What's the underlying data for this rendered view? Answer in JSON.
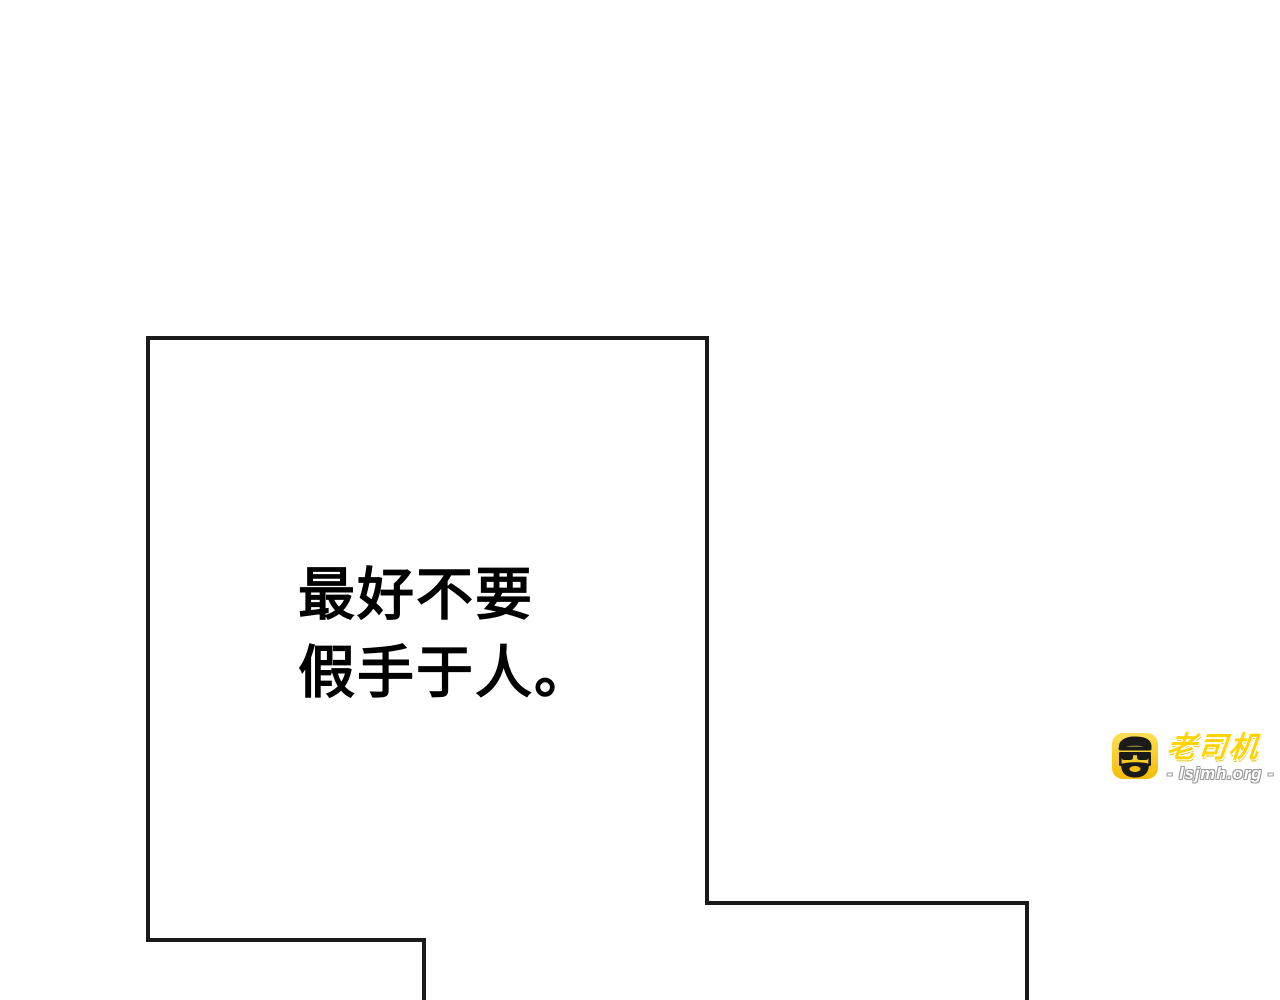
{
  "page": {
    "background_color": "#ffffff"
  },
  "panel": {
    "border_color": "#1a1a1a"
  },
  "speech": {
    "lines": [
      "最好不要",
      "假手于人。"
    ],
    "text_color": "#000000"
  },
  "watermark": {
    "brand": "老司机",
    "site": "- lsjmh.org -",
    "icon": "driver-face-icon",
    "icon_background_color": "#ffd400",
    "icon_face_color": "#1a1a1a",
    "brand_color": "#ffd400",
    "site_color": "#ffffff"
  }
}
